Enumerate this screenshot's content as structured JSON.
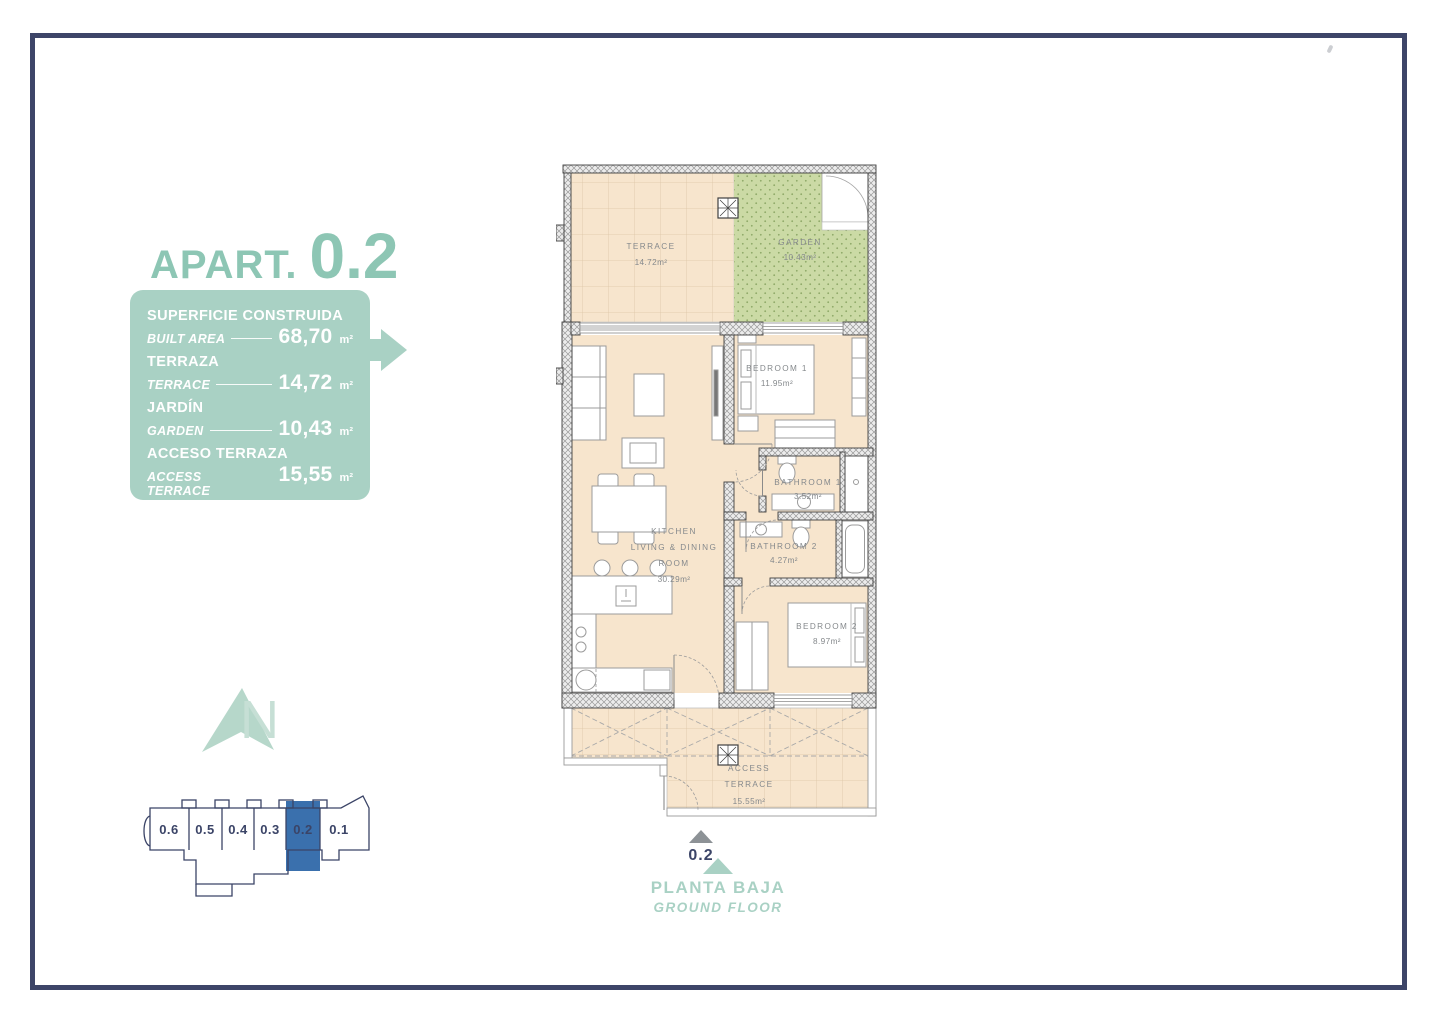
{
  "page": {
    "frame_color": "#3d4568",
    "background": "#ffffff"
  },
  "header": {
    "title_prefix": "APART.",
    "title_number": "0.2",
    "accent_color": "#8dc6b4"
  },
  "summary_box": {
    "bg_color": "#a9d1c4",
    "rows": [
      {
        "label_es": "SUPERFICIE CONSTRUIDA",
        "label_en": "BUILT AREA",
        "value": "68,70",
        "unit": "m²"
      },
      {
        "label_es": "TERRAZA",
        "label_en": "TERRACE",
        "value": "14,72",
        "unit": "m²"
      },
      {
        "label_es": "JARDÍN",
        "label_en": "GARDEN",
        "value": "10,43",
        "unit": "m²"
      },
      {
        "label_es": "ACCESO TERRAZA",
        "label_en": "ACCESS TERRACE",
        "value": "15,55",
        "unit": "m²"
      }
    ],
    "total": {
      "label": "TOTAL",
      "value": "109,40",
      "unit": "m²"
    }
  },
  "compass": {
    "letter": "N"
  },
  "mini_map": {
    "units": [
      "0.6",
      "0.5",
      "0.4",
      "0.3",
      "0.2",
      "0.1"
    ],
    "highlighted_unit": "0.2",
    "highlight_color": "#3a70ad",
    "outline_color": "#3b4467"
  },
  "floor_plan": {
    "terrace": {
      "name": "TERRACE",
      "area": "14.72m²"
    },
    "garden": {
      "name": "GARDEN",
      "area": "10.43m²"
    },
    "bedroom1": {
      "name": "BEDROOM 1",
      "area": "11.95m²"
    },
    "bathroom1": {
      "name": "BATHROOM 1",
      "area": "3.52m²"
    },
    "bathroom2": {
      "name": "BATHROOM 2",
      "area": "4.27m²"
    },
    "kitchen": {
      "line1": "KITCHEN",
      "line2": "LIVING & DINING",
      "line3": "ROOM",
      "area": "30.29m²"
    },
    "bedroom2": {
      "name": "BEDROOM 2",
      "area": "8.97m²"
    },
    "access_terrace": {
      "line1": "ACCESS",
      "line2": "TERRACE",
      "area": "15.55m²"
    },
    "unit_marker": "0.2"
  },
  "footer": {
    "floor_es": "PLANTA BAJA",
    "floor_en": "GROUND FLOOR"
  },
  "colors": {
    "plan_beige": "#f7e5cd",
    "garden_green": "#cbdaa5",
    "wall_dark": "#3f3f3f",
    "label_gray": "#85898c",
    "navy": "#3b4467"
  }
}
